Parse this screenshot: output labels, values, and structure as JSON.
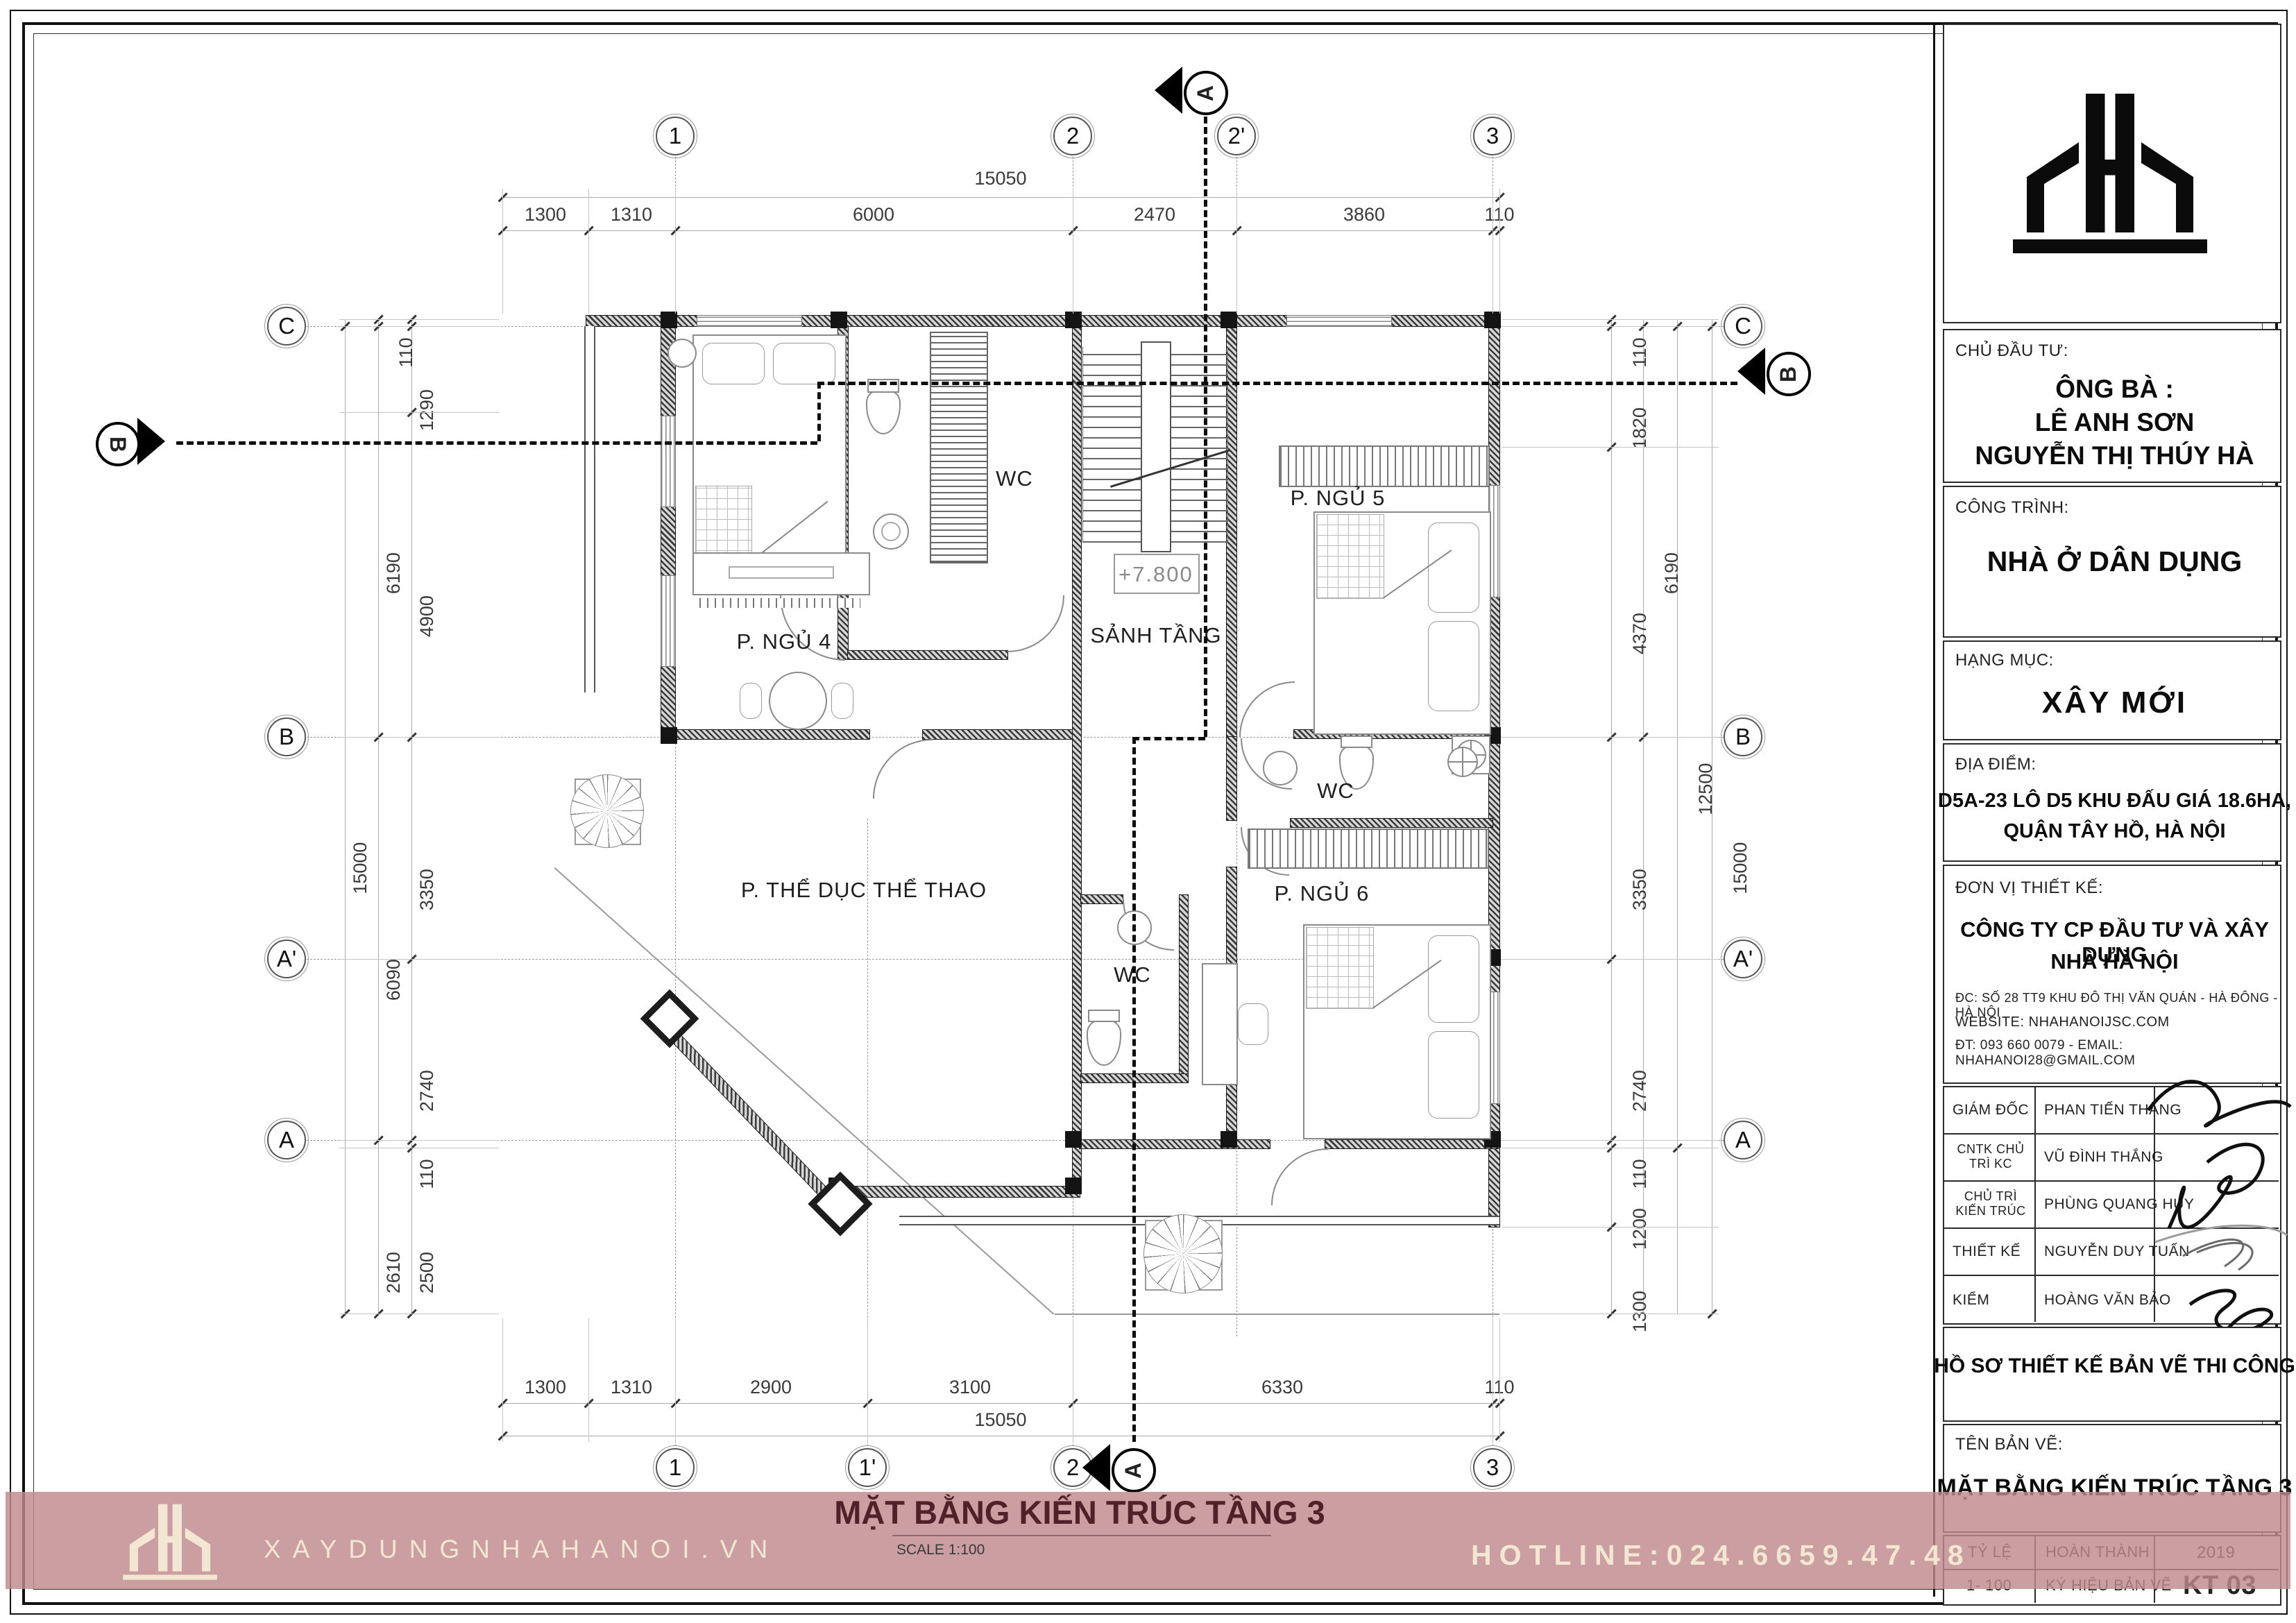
{
  "plan": {
    "title": "MẶT BẰNG KIẾN TRÚC TẦNG 3",
    "scale_note": "SCALE 1:100",
    "level_mark": "+7.800",
    "rooms": {
      "bed4": "P. NGỦ 4",
      "wc_top": "WC",
      "hall": "SẢNH TẦNG",
      "bed5": "P. NGỦ 5",
      "wc_mid": "WC",
      "bed6": "P. NGỦ 6",
      "wc_bottom": "WC",
      "gym": "P. THỂ DỤC THỂ THAO"
    },
    "grid": {
      "top": [
        "1",
        "2",
        "2'",
        "3"
      ],
      "bottom": [
        "1",
        "1'",
        "2",
        "3"
      ],
      "left": [
        "C",
        "B",
        "A'",
        "A"
      ],
      "right": [
        "C",
        "B",
        "A'",
        "A"
      ],
      "section_a": "A",
      "section_b": "B"
    },
    "dims": {
      "top_total": "15050",
      "top_segments": [
        "1300",
        "1310",
        "6000",
        "2470",
        "3860",
        "110"
      ],
      "bottom_segments": [
        "1300",
        "1310",
        "2900",
        "3100",
        "6330",
        "110"
      ],
      "bottom_total": "15050",
      "left_inner": [
        "110",
        "1290",
        "4900",
        "3350",
        "2740",
        "110",
        "2500"
      ],
      "left_mid": [
        "6190",
        "6090",
        "2610"
      ],
      "left_outer": "15000",
      "right_inner": [
        "110",
        "1820",
        "4370",
        "3350",
        "2740",
        "110",
        "1200",
        "1300"
      ],
      "right_mid": [
        "6190",
        "12500"
      ],
      "right_outer": "15000"
    }
  },
  "title_block": {
    "chu_dau_tu_label": "CHỦ ĐẦU TƯ:",
    "owner_line1": "ÔNG BÀ :",
    "owner_line2": "LÊ ANH SƠN",
    "owner_line3": "NGUYỄN THỊ THÚY HÀ",
    "cong_trinh_label": "CÔNG TRÌNH:",
    "cong_trinh_value": "NHÀ Ở DÂN DỤNG",
    "hang_muc_label": "HẠNG MỤC:",
    "hang_muc_value": "XÂY MỚI",
    "dia_diem_label": "ĐỊA ĐIỂM:",
    "dia_diem_line1": "D5A-23 LÔ D5 KHU ĐẤU GIÁ 18.6HA,",
    "dia_diem_line2": "QUẬN TÂY HỒ, HÀ NỘI",
    "don_vi_label": "ĐƠN VỊ THIẾT KẾ:",
    "company_line1": "CÔNG TY CP ĐẦU TƯ VÀ XÂY DỰNG",
    "company_line2": "NHÀ HÀ NỘI",
    "company_address": "ĐC: SỐ 28 TT9 KHU ĐÔ THỊ VĂN QUÁN - HÀ ĐÔNG - HÀ NỘI",
    "company_website": "WEBSITE: NHAHANOIJSC.COM",
    "company_contact": "ĐT: 093 660 0079 - EMAIL: NHAHANOI28@GMAIL.COM",
    "signers": [
      {
        "role": "GIÁM ĐỐC",
        "name": "PHAN TIẾN THẮNG"
      },
      {
        "role": "CNTK CHỦ TRÌ KC",
        "name": "VŨ ĐÌNH THẮNG"
      },
      {
        "role": "CHỦ TRÌ KIẾN TRÚC",
        "name": "PHÙNG QUANG HUY"
      },
      {
        "role": "THIẾT KẾ",
        "name": "NGUYỄN DUY TUẤN"
      },
      {
        "role": "KIỂM",
        "name": "HOÀNG VĂN BẢO"
      }
    ],
    "ho_so": "HỒ SƠ THIẾT KẾ BẢN VẼ THI CÔNG",
    "ten_ban_ve_label": "TÊN BẢN VẼ:",
    "ten_ban_ve_value": "MẶT BẰNG KIẾN TRÚC TẦNG 3",
    "ty_le_label": "TỶ LỆ",
    "ty_le_value": "1- 100",
    "hoan_thanh_label": "HOÀN THÀNH",
    "year": "2019",
    "ky_hieu_label": "KÝ HIỆU BẢN VẼ",
    "sheet_code": "KT  03"
  },
  "footer": {
    "website": "XAYDUNGNHAHANOI.VN",
    "hotline": "HOTLINE:024.6659.47.48"
  },
  "colors": {
    "band_pink": "#c0898d",
    "cream": "#f3e7d3",
    "title_maroon": "#4f2129"
  }
}
